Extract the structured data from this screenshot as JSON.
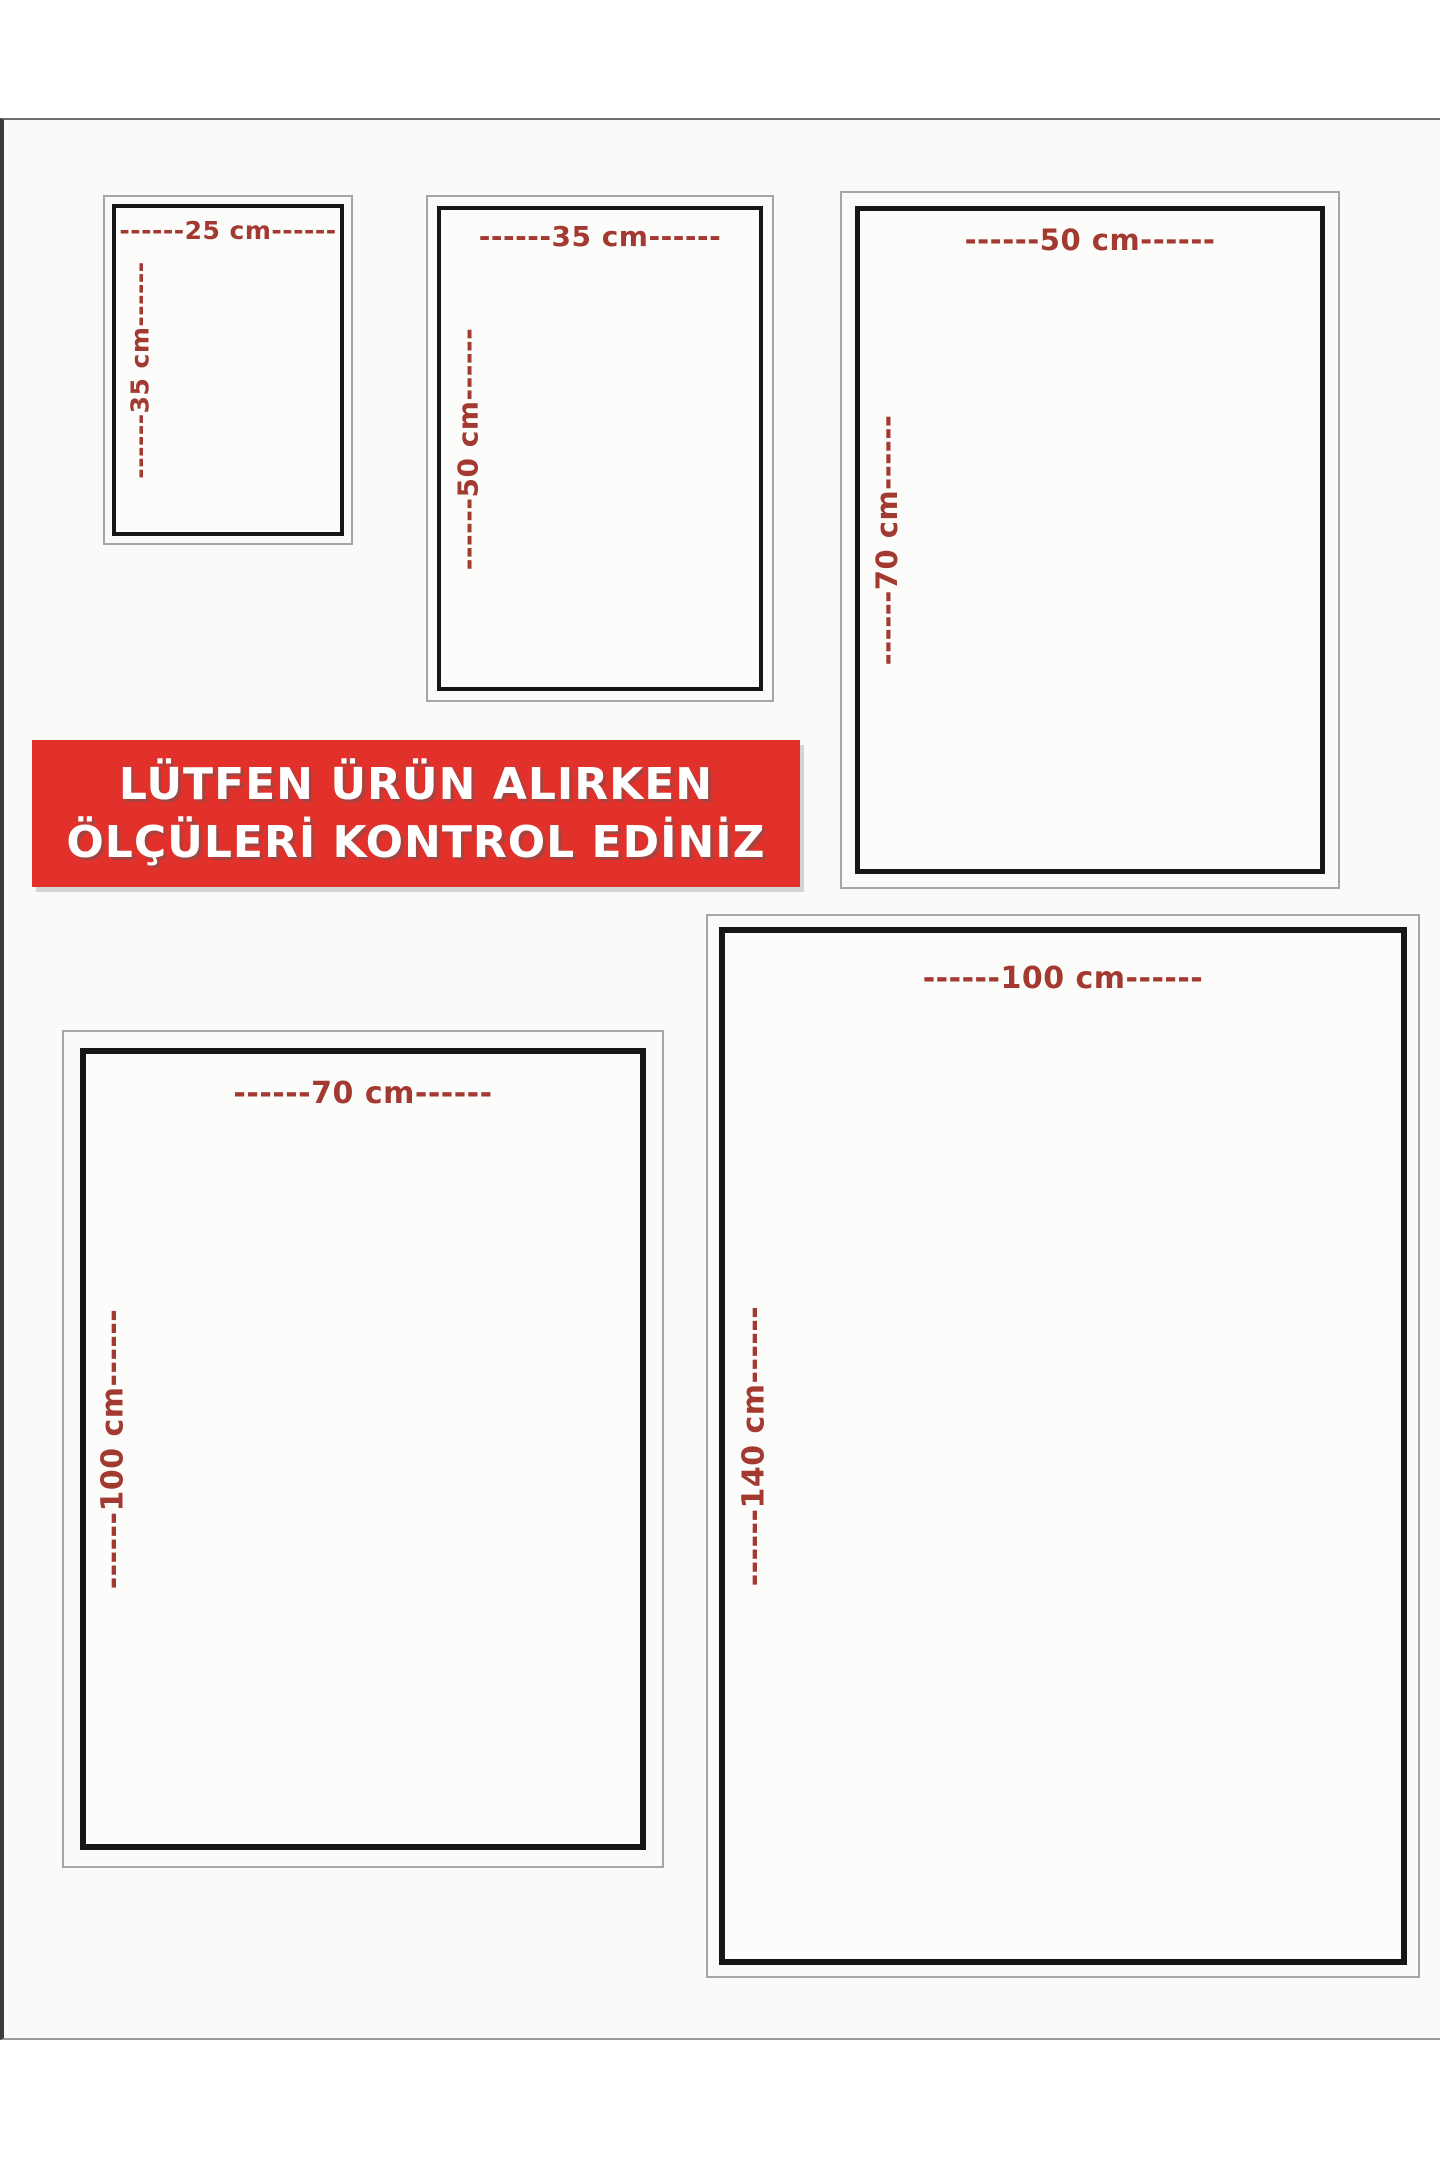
{
  "page": {
    "background": "#ffffff",
    "photo_background": "#fafaf9"
  },
  "banner": {
    "line1": "LÜTFEN ÜRÜN ALIRKEN",
    "line2": "ÖLÇÜLERİ KONTROL EDİNİZ",
    "bg_color": "#e2312b",
    "text_color": "#ffffff"
  },
  "colors": {
    "dimension_text": "#a33a31",
    "frame_border": "#161616",
    "outer_border": "#a6a6a6"
  },
  "sizes": [
    {
      "name": "25x35 cm",
      "width_cm": 25,
      "height_cm": 35,
      "width_label": "------25 cm------",
      "height_label": "------35 cm------"
    },
    {
      "name": "35x50 cm",
      "width_cm": 35,
      "height_cm": 50,
      "width_label": "------35 cm------",
      "height_label": "------50 cm------"
    },
    {
      "name": "50x70 cm",
      "width_cm": 50,
      "height_cm": 70,
      "width_label": "------50 cm------",
      "height_label": "------70 cm------"
    },
    {
      "name": "70x100 cm",
      "width_cm": 70,
      "height_cm": 100,
      "width_label": "------70 cm------",
      "height_label": "------100 cm------"
    },
    {
      "name": "100x140 cm",
      "width_cm": 100,
      "height_cm": 140,
      "width_label": "------100 cm------",
      "height_label": "------140 cm------"
    }
  ]
}
